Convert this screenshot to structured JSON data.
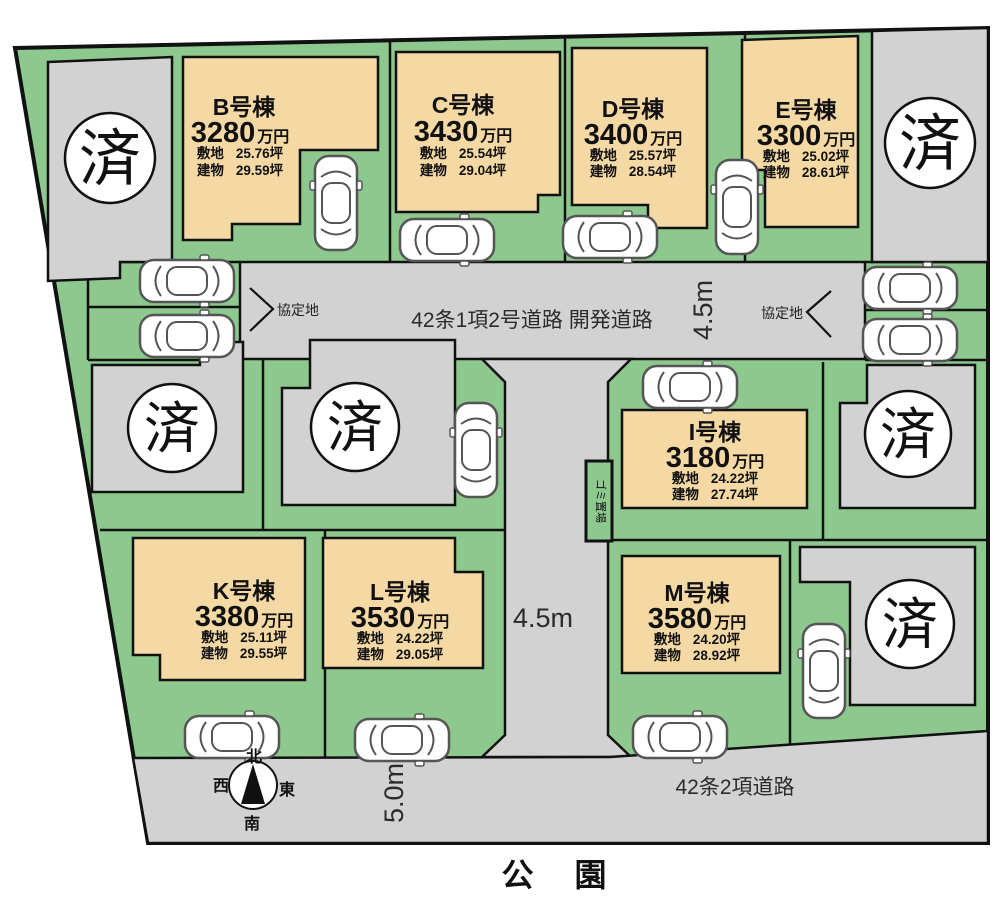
{
  "map": {
    "sold_label": "済",
    "park_label": "公 園",
    "garbage_label": "ゴミ置場",
    "agreement_label": "協定地",
    "compass": {
      "north": "北",
      "south": "南",
      "east": "東",
      "west": "西"
    },
    "roads": {
      "north_road_label": "42条1項2号道路 開発道路",
      "north_road_width": "4.5m",
      "center_road_width": "4.5m",
      "south_road_width": "5.0m",
      "south_road_label": "42条2項道路"
    },
    "colors": {
      "site_green": "#8dc98e",
      "road_gray": "#d2d2d2",
      "lot_beige": "#f5d9a5",
      "outline": "#111111",
      "sold_circle": "#ffffff"
    }
  },
  "lots": [
    {
      "id": "B",
      "name": "B号棟",
      "price": "3280",
      "price_unit": "万円",
      "land_label": "敷地",
      "land_area": "25.76坪",
      "building_label": "建物",
      "building_area": "29.59坪"
    },
    {
      "id": "C",
      "name": "C号棟",
      "price": "3430",
      "price_unit": "万円",
      "land_label": "敷地",
      "land_area": "25.54坪",
      "building_label": "建物",
      "building_area": "29.04坪"
    },
    {
      "id": "D",
      "name": "D号棟",
      "price": "3400",
      "price_unit": "万円",
      "land_label": "敷地",
      "land_area": "25.57坪",
      "building_label": "建物",
      "building_area": "28.54坪"
    },
    {
      "id": "E",
      "name": "E号棟",
      "price": "3300",
      "price_unit": "万円",
      "land_label": "敷地",
      "land_area": "25.02坪",
      "building_label": "建物",
      "building_area": "28.61坪"
    },
    {
      "id": "I",
      "name": "I号棟",
      "price": "3180",
      "price_unit": "万円",
      "land_label": "敷地",
      "land_area": "24.22坪",
      "building_label": "建物",
      "building_area": "27.74坪"
    },
    {
      "id": "K",
      "name": "K号棟",
      "price": "3380",
      "price_unit": "万円",
      "land_label": "敷地",
      "land_area": "25.11坪",
      "building_label": "建物",
      "building_area": "29.55坪"
    },
    {
      "id": "L",
      "name": "L号棟",
      "price": "3530",
      "price_unit": "万円",
      "land_label": "敷地",
      "land_area": "24.22坪",
      "building_label": "建物",
      "building_area": "29.05坪"
    },
    {
      "id": "M",
      "name": "M号棟",
      "price": "3580",
      "price_unit": "万円",
      "land_label": "敷地",
      "land_area": "24.20坪",
      "building_label": "建物",
      "building_area": "28.92坪"
    }
  ]
}
